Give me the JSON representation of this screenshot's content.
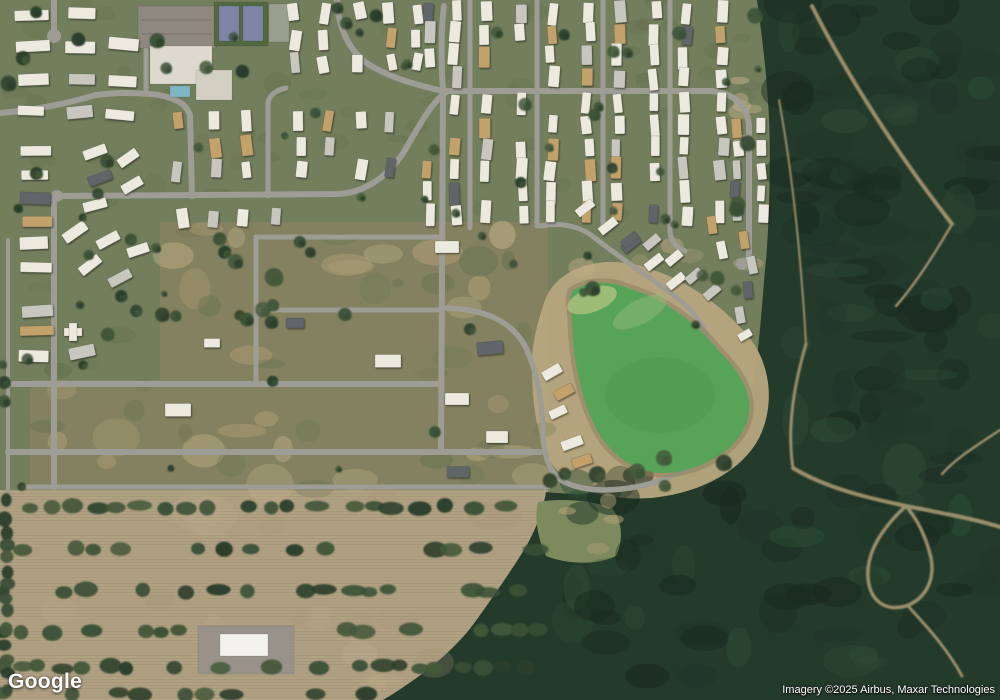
{
  "branding": {
    "logo_text": "Google",
    "attribution_text": "Imagery ©2025 Airbus, Maxar Technologies"
  },
  "canvas": {
    "width": 1000,
    "height": 700
  },
  "seed": 1337,
  "palette": {
    "grass": "#727e5c",
    "dev_land": "#83815f",
    "field": "#b1a183",
    "field_rows_line": "#94846a",
    "forest": "#243a2b",
    "road": "#9d9d95",
    "dirt": "#b7a67e",
    "dirt_dark": "#8c7f5f",
    "pond": "#58a35a",
    "trail": "#b8a37a",
    "light_patch": "#7c8a5e",
    "lawn_mottle": "#55613f",
    "tree": [
      "#3a5036",
      "#2c3f2b",
      "#44583a"
    ],
    "house": {
      "w": "#eceadf",
      "g": "#c8c7bf",
      "t": "#c2a26a",
      "d": "#5f6568"
    },
    "school_parking": "#8e897f",
    "school_building": "#ded9cf",
    "school_wing": "#d4cfc3",
    "pool": "#7fb6c4",
    "court_pad": "#53683f",
    "court": "#7e84a6",
    "pad2": "#9aa08f",
    "barn_pad": "#98928a",
    "barn": "#f2f1ec"
  },
  "regions": {
    "dev": "M 160,222 L 548,222 L 548,492 L 30,492 L 30,380 L 160,380 Z",
    "field": {
      "x": 0,
      "y": 490,
      "w": 548,
      "h": 210
    },
    "forest": "M 757,0 L 1000,0 L 1000,700 L 383,700 C 420,678 455,650 475,622 C 498,590 515,565 527,545 C 538,524 543,510 546,492 C 590,497 640,491 678,471 C 714,452 742,426 751,394 C 758,362 761,318 765,270 C 769,235 771,165 769,118 C 767,75 762,36 757,0 Z",
    "light_patch": "M 538,502 C 560,498 590,500 612,508 C 622,520 624,540 616,556 C 596,566 566,564 546,556 C 538,540 534,518 538,502 Z",
    "pond_ring": "M 545,300 C 555,272 592,256 632,264 C 680,274 726,306 754,344 C 772,372 774,410 758,440 C 740,472 698,494 650,498 C 608,501 570,490 552,464 C 536,440 532,400 532,364 C 532,340 539,318 545,300 Z",
    "pond": "M 572,291 C 588,281 608,280 628,288 C 662,298 696,322 718,350 C 736,368 747,384 749,402 C 751,422 741,440 721,454 C 699,469 671,477 647,471 C 625,465 606,449 595,426 C 581,399 573,358 572,323 C 572,309 568,299 572,291 Z"
  },
  "algae": [
    [
      592,
      300,
      26,
      12,
      -20,
      "#a8c17e",
      0.85
    ],
    [
      640,
      312,
      30,
      12,
      -28,
      "#8fba75",
      0.5
    ],
    [
      660,
      395,
      55,
      38,
      0,
      "#4f9a52",
      0.55
    ]
  ],
  "roads": [
    {
      "d": "M 54,0 L 54,31",
      "w": 6
    },
    {
      "d": "M 0,113 C 38,110 68,103 96,95 C 120,92 135,93 150,94 C 172,96 186,103 190,115 L 192,196",
      "w": 6
    },
    {
      "d": "M 146,94 L 146,47",
      "w": 5
    },
    {
      "d": "M 268,196 L 268,104 C 268,96 276,90 286,88",
      "w": 5
    },
    {
      "d": "M 57,196 L 338,194 C 365,193 390,175 405,150 C 418,128 430,104 446,92",
      "w": 6
    },
    {
      "d": "M 337,0 C 338,26 348,50 368,64 C 390,78 420,86 443,91",
      "w": 6
    },
    {
      "d": "M 443,91 C 441,60 441,30 444,6",
      "w": 6
    },
    {
      "d": "M 443,91 L 441,452",
      "w": 6
    },
    {
      "d": "M 443,91 L 712,91 C 736,94 748,107 749,127 L 749,252 C 749,260 746,264 742,266",
      "w": 6
    },
    {
      "d": "M 470,0 L 470,228",
      "w": 5
    },
    {
      "d": "M 537,0 L 537,226",
      "w": 5
    },
    {
      "d": "M 603,0 L 603,226",
      "w": 5
    },
    {
      "d": "M 670,0 L 670,230 C 670,241 676,247 685,251",
      "w": 5
    },
    {
      "d": "M 54,196 L 54,487",
      "w": 6
    },
    {
      "d": "M 8,240 L 8,504",
      "w": 4
    },
    {
      "d": "M 0,384 L 441,384",
      "w": 6
    },
    {
      "d": "M 8,452 L 540,452",
      "w": 6
    },
    {
      "d": "M 22,487 L 548,487",
      "w": 5
    },
    {
      "d": "M 256,237 L 443,237",
      "w": 5
    },
    {
      "d": "M 256,237 L 256,384",
      "w": 5
    },
    {
      "d": "M 258,310 L 441,310",
      "w": 5
    },
    {
      "d": "M 441,308 C 482,308 512,320 526,348 C 538,374 542,402 543,430 C 543,452 549,472 561,480 C 581,492 611,492 641,486 C 669,480 689,468 703,454",
      "w": 5.5
    },
    {
      "d": "M 540,226 C 562,222 580,226 595,238 C 625,262 658,282 682,302 C 700,318 707,332 709,346",
      "w": 5
    }
  ],
  "culdesacs": [
    [
      54,
      36,
      7
    ],
    [
      709,
      349,
      7
    ],
    [
      742,
      264,
      6
    ],
    [
      57,
      196,
      6
    ]
  ],
  "trails": [
    {
      "d": "M 812,6 C 836,54 886,140 952,224",
      "w": 4
    },
    {
      "d": "M 952,224 C 930,262 912,288 896,306",
      "w": 2.5
    },
    {
      "d": "M 779,100 C 790,160 800,240 806,344",
      "w": 2
    },
    {
      "d": "M 806,344 C 793,388 787,430 793,468",
      "w": 3
    },
    {
      "d": "M 793,468 C 826,488 868,498 906,506 C 948,514 978,520 1000,527",
      "w": 4
    },
    {
      "d": "M 906,506 C 882,528 866,552 868,578 C 870,600 884,612 906,606 C 928,598 936,576 930,554 C 926,538 918,520 906,506",
      "w": 3.5
    },
    {
      "d": "M 908,606 C 930,630 948,650 962,676",
      "w": 3
    },
    {
      "d": "M 1000,430 C 976,446 956,458 942,474",
      "w": 2.5
    }
  ],
  "texture_scatters": [
    {
      "colors": [
        "#55613f"
      ],
      "n": 60,
      "x": [
        0,
        760
      ],
      "y": [
        0,
        232
      ],
      "r": [
        6,
        16
      ],
      "op": [
        0.1,
        0.2
      ]
    },
    {
      "colors": [
        "#b2a078",
        "#c3b28b"
      ],
      "n": 26,
      "x": [
        40,
        545
      ],
      "y": [
        228,
        496
      ],
      "r": [
        8,
        26
      ],
      "op": [
        0.3,
        0.55
      ]
    },
    {
      "colors": [
        "#6c7852",
        "#5d6b49"
      ],
      "n": 28,
      "x": [
        35,
        545
      ],
      "y": [
        228,
        496
      ],
      "r": [
        6,
        20
      ],
      "op": [
        0.25,
        0.4
      ]
    },
    {
      "colors": [
        "#b2a078",
        "#c0ae85"
      ],
      "n": 10,
      "x": [
        548,
        765
      ],
      "y": [
        230,
        340
      ],
      "r": [
        6,
        16
      ],
      "op": [
        0.3,
        0.5
      ]
    },
    {
      "colors": [
        "#18291d",
        "#2f4d37",
        "#203527"
      ],
      "n": 85,
      "x": [
        782,
        1000
      ],
      "y": [
        0,
        470
      ],
      "r": [
        10,
        32
      ],
      "op": [
        0.3,
        0.55
      ]
    },
    {
      "colors": [
        "#18291d",
        "#2f4d37",
        "#203527"
      ],
      "n": 55,
      "x": [
        570,
        1000
      ],
      "y": [
        475,
        700
      ],
      "r": [
        10,
        28
      ],
      "op": [
        0.3,
        0.55
      ]
    },
    {
      "colors": [
        "#c4b48f",
        "#a59372"
      ],
      "n": 16,
      "x": [
        0,
        520
      ],
      "y": [
        495,
        688
      ],
      "r": [
        10,
        30
      ],
      "op": [
        0.12,
        0.28
      ]
    },
    {
      "colors": [
        "#bfae85"
      ],
      "n": 7,
      "x": [
        738,
        772
      ],
      "y": [
        55,
        150
      ],
      "r": [
        7,
        13
      ],
      "op": [
        0.45,
        0.65
      ]
    },
    {
      "colors": [
        "#b3a178"
      ],
      "n": 4,
      "x": [
        545,
        620
      ],
      "y": [
        500,
        560
      ],
      "r": [
        6,
        12
      ],
      "op": [
        0.4,
        0.6
      ]
    }
  ],
  "tree_scatters": [
    {
      "n": 46,
      "x": [
        4,
        758
      ],
      "y": [
        2,
        230
      ],
      "r": [
        3.5,
        8
      ]
    },
    {
      "n": 14,
      "x": [
        155,
        345
      ],
      "y": [
        235,
        325
      ],
      "r": [
        5,
        10
      ]
    },
    {
      "n": 10,
      "x": [
        548,
        758
      ],
      "y": [
        185,
        340
      ],
      "r": [
        4,
        8
      ]
    },
    {
      "n": 8,
      "x": [
        60,
        165
      ],
      "y": [
        230,
        385
      ],
      "r": [
        4,
        7
      ]
    },
    {
      "n": 8,
      "x": [
        160,
        540
      ],
      "y": [
        235,
        490
      ],
      "r": [
        3,
        6
      ]
    },
    {
      "n": 7,
      "x": [
        545,
        745
      ],
      "y": [
        455,
        495
      ],
      "r": [
        5,
        9
      ]
    },
    {
      "n": 5,
      "x": [
        2,
        28
      ],
      "y": [
        235,
        505
      ],
      "r": [
        4,
        7
      ]
    }
  ],
  "field_tree_rows": {
    "rows": [
      [
        507,
        30,
        540
      ],
      [
        549,
        8,
        540
      ],
      [
        591,
        2,
        540
      ],
      [
        631,
        2,
        540
      ],
      [
        667,
        2,
        540
      ],
      [
        694,
        2,
        388
      ]
    ],
    "barn_gap": [
      188,
      308,
      631
    ],
    "step": [
      14,
      32
    ],
    "rx": [
      7,
      13
    ],
    "ry": [
      5,
      8
    ]
  },
  "left_tree_column": {
    "x": 6,
    "y0": 500,
    "y1": 696,
    "step": [
      11,
      20
    ],
    "r": [
      5,
      8
    ]
  },
  "school": {
    "parking": [
      138,
      6,
      78,
      42
    ],
    "building_main": [
      150,
      46,
      62,
      38
    ],
    "building_wing": [
      196,
      70,
      36,
      30
    ],
    "pool": [
      170,
      86,
      20,
      11
    ],
    "court_pad": [
      214,
      2,
      54,
      44
    ],
    "courts": [
      [
        219,
        6,
        20,
        35
      ],
      [
        243,
        6,
        20,
        35
      ]
    ],
    "pad2": [
      269,
      4,
      20,
      38
    ]
  },
  "barn": {
    "pad": [
      198,
      626,
      96,
      48
    ],
    "building": [
      220,
      634,
      48,
      22
    ]
  },
  "house_grids": [
    {
      "cols": [
        428,
        455,
        485,
        522,
        552,
        588,
        618,
        655,
        685,
        722
      ],
      "rows": [
        12,
        34,
        56,
        78,
        104,
        126,
        148,
        170,
        192,
        214
      ],
      "w": 10,
      "h": 20,
      "rot": 7,
      "skip": 0.12,
      "voids": [
        [
          735,
          40,
          40,
          112
        ],
        [
          400,
          95,
          52,
          60
        ]
      ]
    },
    {
      "cols": [
        737,
        763
      ],
      "rows": [
        126,
        148,
        170,
        192,
        214
      ],
      "w": 9,
      "h": 18,
      "rot": 8,
      "skip": 0.1,
      "voids": []
    },
    {
      "cols": [
        295,
        325,
        358,
        390,
        418
      ],
      "rows": [
        12,
        38,
        64
      ],
      "w": 10,
      "h": 19,
      "rot": 14,
      "skip": 0.15,
      "voids": []
    },
    {
      "cols": [
        32,
        82,
        122
      ],
      "rows": [
        13,
        45,
        79,
        113
      ],
      "w": 30,
      "h": 11,
      "rot": 6,
      "skip": 0.08,
      "voids": []
    },
    {
      "cols": [
        36
      ],
      "rows": [
        152,
        174,
        196,
        222,
        244,
        266,
        288,
        310,
        332,
        354
      ],
      "w": 30,
      "h": 11,
      "rot": 4,
      "skip": 0.05,
      "voids": []
    },
    {
      "cols": [
        176,
        215,
        245,
        300,
        330,
        360,
        388
      ],
      "rows": [
        122,
        146,
        170
      ],
      "w": 10,
      "h": 19,
      "rot": 10,
      "skip": 0.15,
      "voids": []
    },
    {
      "cols": [
        185,
        215,
        245,
        275
      ],
      "rows": [
        218
      ],
      "w": 10,
      "h": 19,
      "rot": 10,
      "skip": 0.1,
      "voids": []
    }
  ],
  "houses": [
    [
      95,
      152,
      24,
      10,
      -20
    ],
    [
      128,
      158,
      22,
      10,
      -35
    ],
    [
      100,
      178,
      24,
      10,
      -20
    ],
    [
      132,
      185,
      22,
      10,
      -30
    ],
    [
      95,
      205,
      24,
      10,
      -15
    ],
    [
      75,
      232,
      26,
      11,
      -35
    ],
    [
      108,
      240,
      24,
      10,
      -28
    ],
    [
      138,
      250,
      22,
      10,
      -18
    ],
    [
      90,
      265,
      24,
      10,
      -38
    ],
    [
      120,
      278,
      24,
      10,
      -28
    ],
    [
      82,
      352,
      26,
      12,
      -12
    ],
    [
      585,
      208,
      20,
      9,
      -38
    ],
    [
      608,
      226,
      20,
      9,
      -38
    ],
    [
      631,
      244,
      20,
      9,
      -38
    ],
    [
      654,
      262,
      20,
      9,
      -38
    ],
    [
      676,
      281,
      20,
      9,
      -38
    ],
    [
      630,
      240,
      18,
      9,
      -38
    ],
    [
      652,
      242,
      18,
      9,
      -40
    ],
    [
      674,
      258,
      18,
      9,
      -40
    ],
    [
      694,
      276,
      18,
      9,
      -40
    ],
    [
      712,
      292,
      18,
      9,
      -40
    ],
    [
      712,
      225,
      9,
      18,
      -8
    ],
    [
      722,
      250,
      9,
      18,
      -12
    ],
    [
      744,
      240,
      9,
      18,
      -8
    ],
    [
      752,
      265,
      9,
      18,
      -12
    ],
    [
      748,
      290,
      9,
      17,
      -5
    ],
    [
      740,
      315,
      9,
      17,
      -10
    ],
    [
      745,
      335,
      14,
      8,
      -30
    ],
    [
      552,
      372,
      20,
      10,
      -30
    ],
    [
      564,
      392,
      20,
      10,
      -28
    ],
    [
      558,
      412,
      18,
      9,
      -25
    ],
    [
      572,
      443,
      22,
      10,
      -20
    ],
    [
      582,
      461,
      20,
      10,
      -18
    ],
    [
      447,
      247,
      24,
      12,
      0,
      "w"
    ],
    [
      490,
      348,
      26,
      13,
      -5,
      "d"
    ],
    [
      457,
      399,
      24,
      12,
      0,
      "w"
    ],
    [
      497,
      437,
      22,
      12,
      0,
      "w"
    ],
    [
      458,
      472,
      22,
      11,
      0,
      "d"
    ],
    [
      388,
      361,
      26,
      13,
      0,
      "w"
    ],
    [
      178,
      410,
      26,
      13,
      0,
      "w"
    ],
    [
      295,
      323,
      18,
      10,
      0,
      "d"
    ],
    [
      212,
      343,
      16,
      9,
      0,
      "w"
    ]
  ],
  "cross_building": [
    [
      64,
      328,
      18,
      8
    ],
    [
      69,
      323,
      8,
      18
    ]
  ]
}
